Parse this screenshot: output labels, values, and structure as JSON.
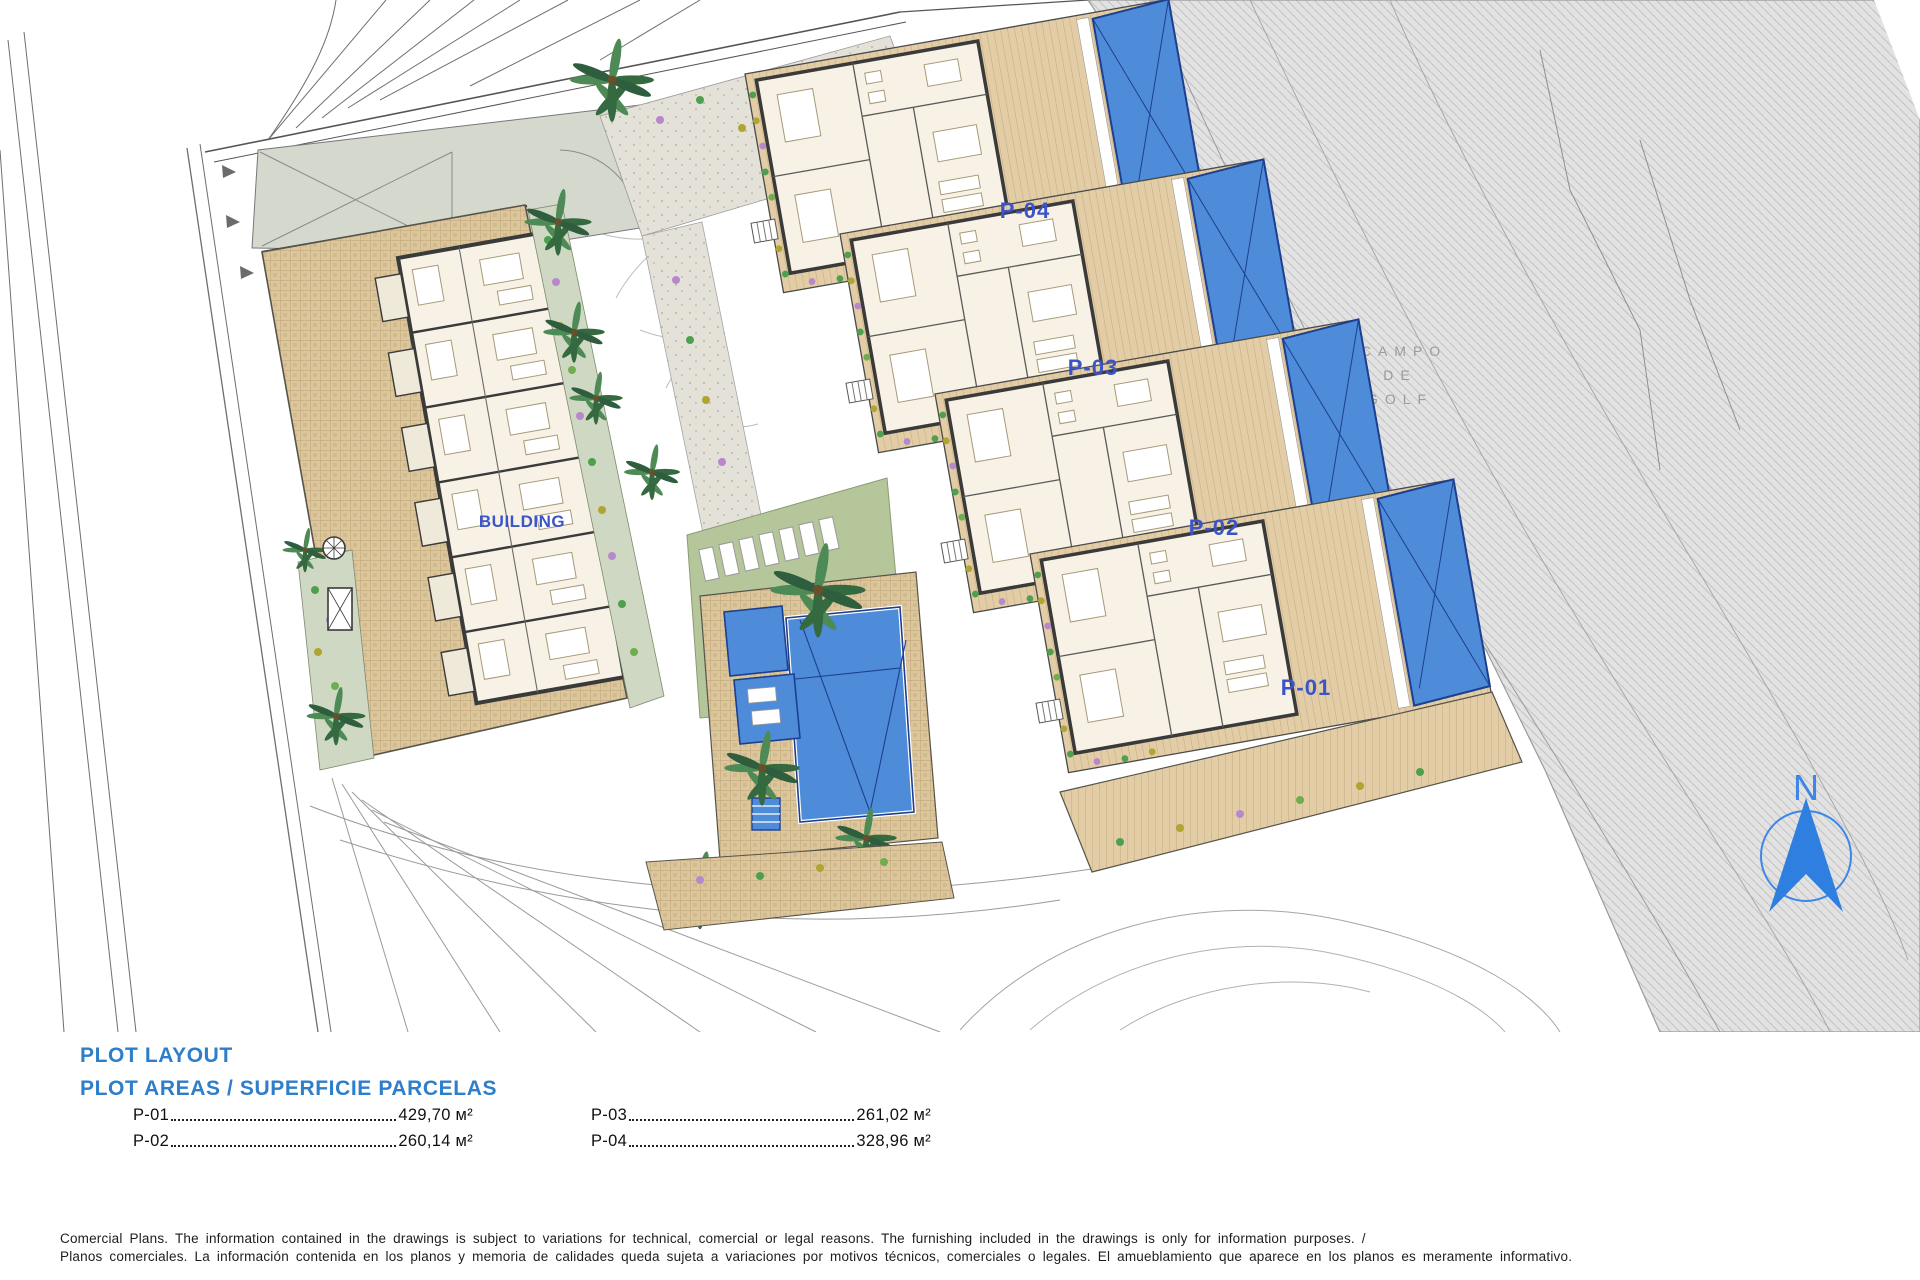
{
  "plan": {
    "building_label": "BUILDING",
    "labels": {
      "p01": "P-01",
      "p02": "P-02",
      "p03": "P-03",
      "p04": "P-04"
    },
    "golf_label": {
      "line1": "CAMPO",
      "line2": "DE",
      "line3": "GOLF"
    },
    "north_label": "N"
  },
  "legend": {
    "title": "PLOT LAYOUT",
    "subtitle": "PLOT AREAS / SUPERFICIE PARCELAS",
    "areas": [
      {
        "plot": "P-01",
        "area": "429,70 м²"
      },
      {
        "plot": "P-02",
        "area": "260,14 м²"
      },
      {
        "plot": "P-03",
        "area": "261,02 м²"
      },
      {
        "plot": "P-04",
        "area": "328,96 м²"
      }
    ]
  },
  "disclaimer": {
    "en": "Comercial Plans. The information contained in the drawings is subject to variations for technical, comercial or legal reasons. The furnishing included in the drawings is only for information purposes. /",
    "es": "Planos comerciales. La información contenida en los planos y memoria de calidades queda sujeta a variaciones por motivos técnicos, comerciales o legales. El amueblamiento que aparece en los planos es meramente informativo."
  },
  "colors": {
    "heading_blue": "#2e7ec9",
    "plan_label_blue": "#3b55c9",
    "pool_blue": "#4e8bd8",
    "pool_edge": "#1d3f8f",
    "terrace_tan": "#dcc79d",
    "plank_tan": "#e2cda6",
    "lawn_green": "#b6c69b",
    "sage": "#d4d8cd",
    "golf_gray": "#e2e2e2",
    "golf_text_gray": "#9b9b9b",
    "compass_blue": "#3b86e8",
    "wall_dark": "#3a3a3a"
  }
}
